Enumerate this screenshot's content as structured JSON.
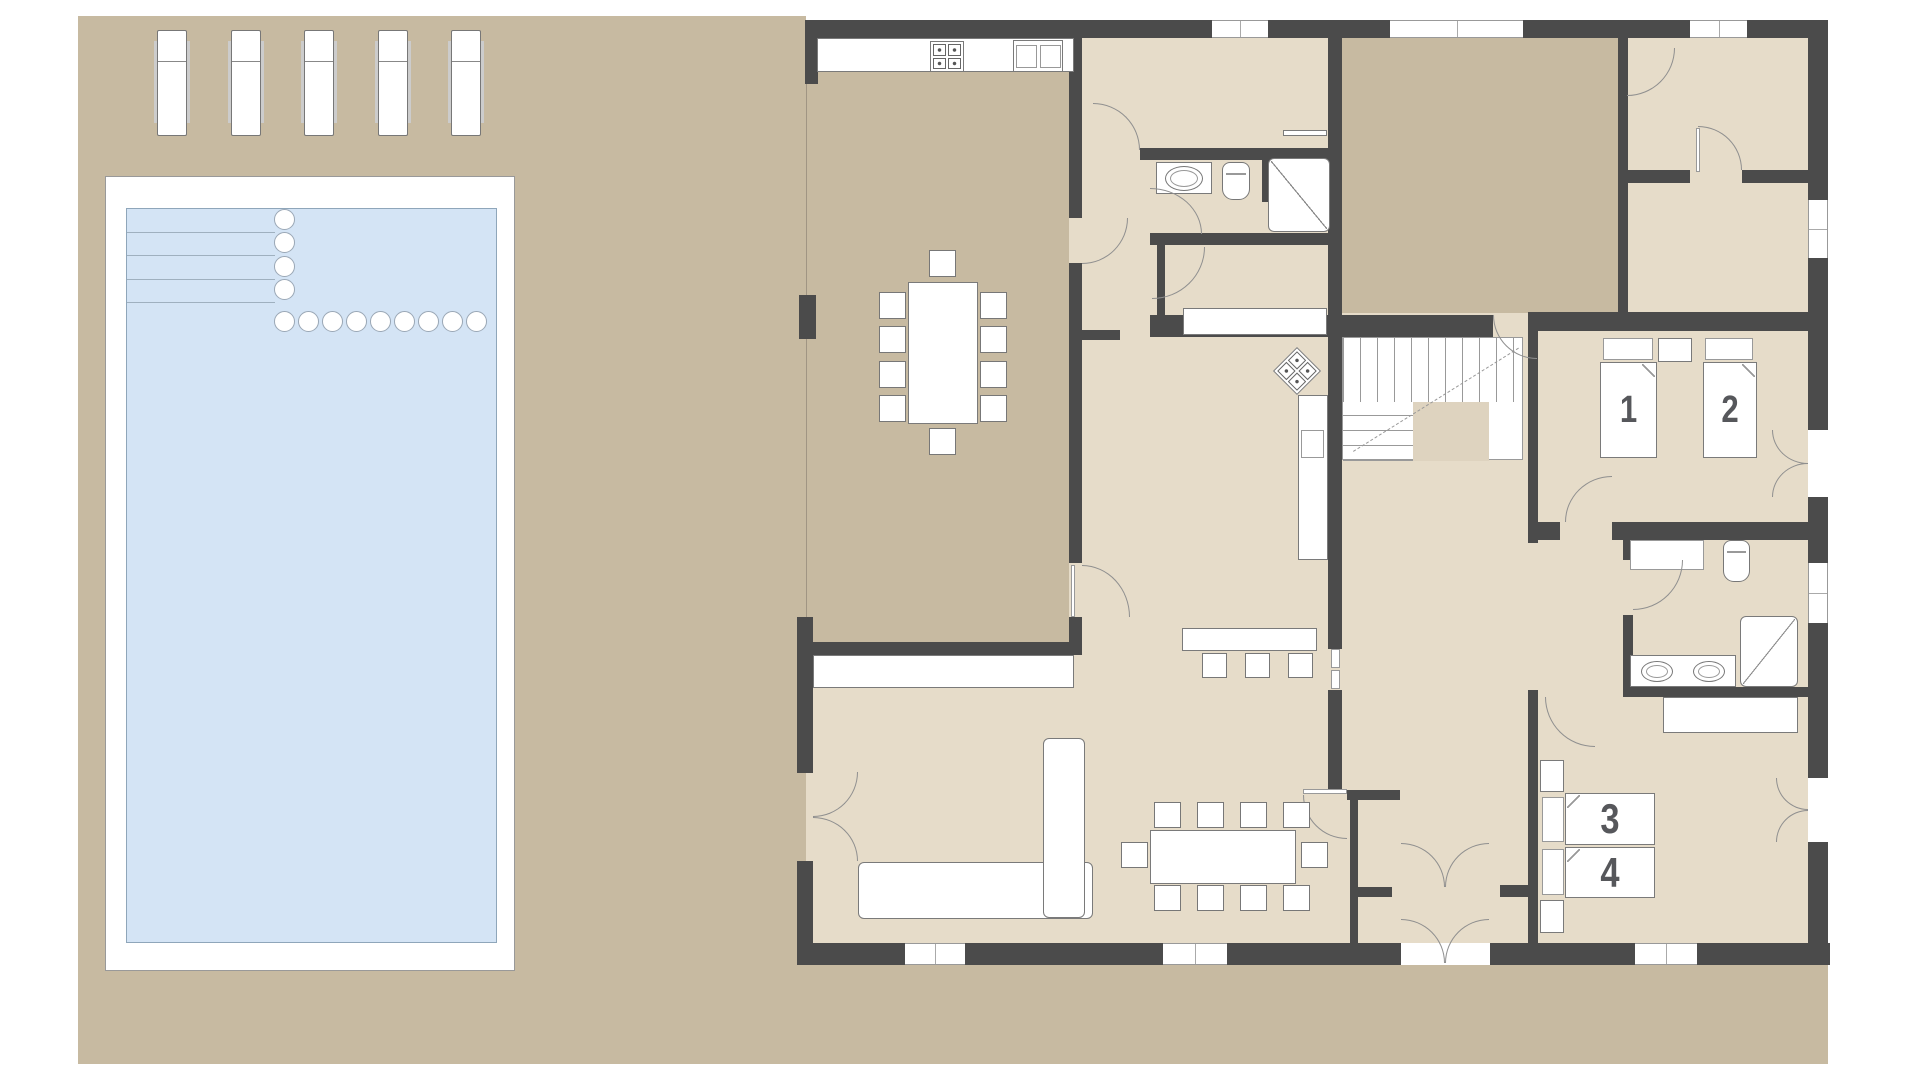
{
  "plan": {
    "beds": [
      {
        "label": "1"
      },
      {
        "label": "2"
      },
      {
        "label": "3"
      },
      {
        "label": "4"
      }
    ],
    "counts": {
      "sun_loungers": 5,
      "pool_lap_lines": 4,
      "pool_circle_column": 4,
      "pool_circle_row": 9,
      "terrace_dining_chairs": 10,
      "indoor_dining_chairs": 10,
      "bar_stools": 3
    },
    "colors": {
      "wall": "#4b4b4b",
      "outdoor_ground": "#c7baa1",
      "room_floor": "#e6dcc9",
      "stair_landing": "#ded3bf",
      "pool_water": "#d4e4f5",
      "furniture": "#ffffff",
      "bed_number": "#56575b"
    }
  }
}
